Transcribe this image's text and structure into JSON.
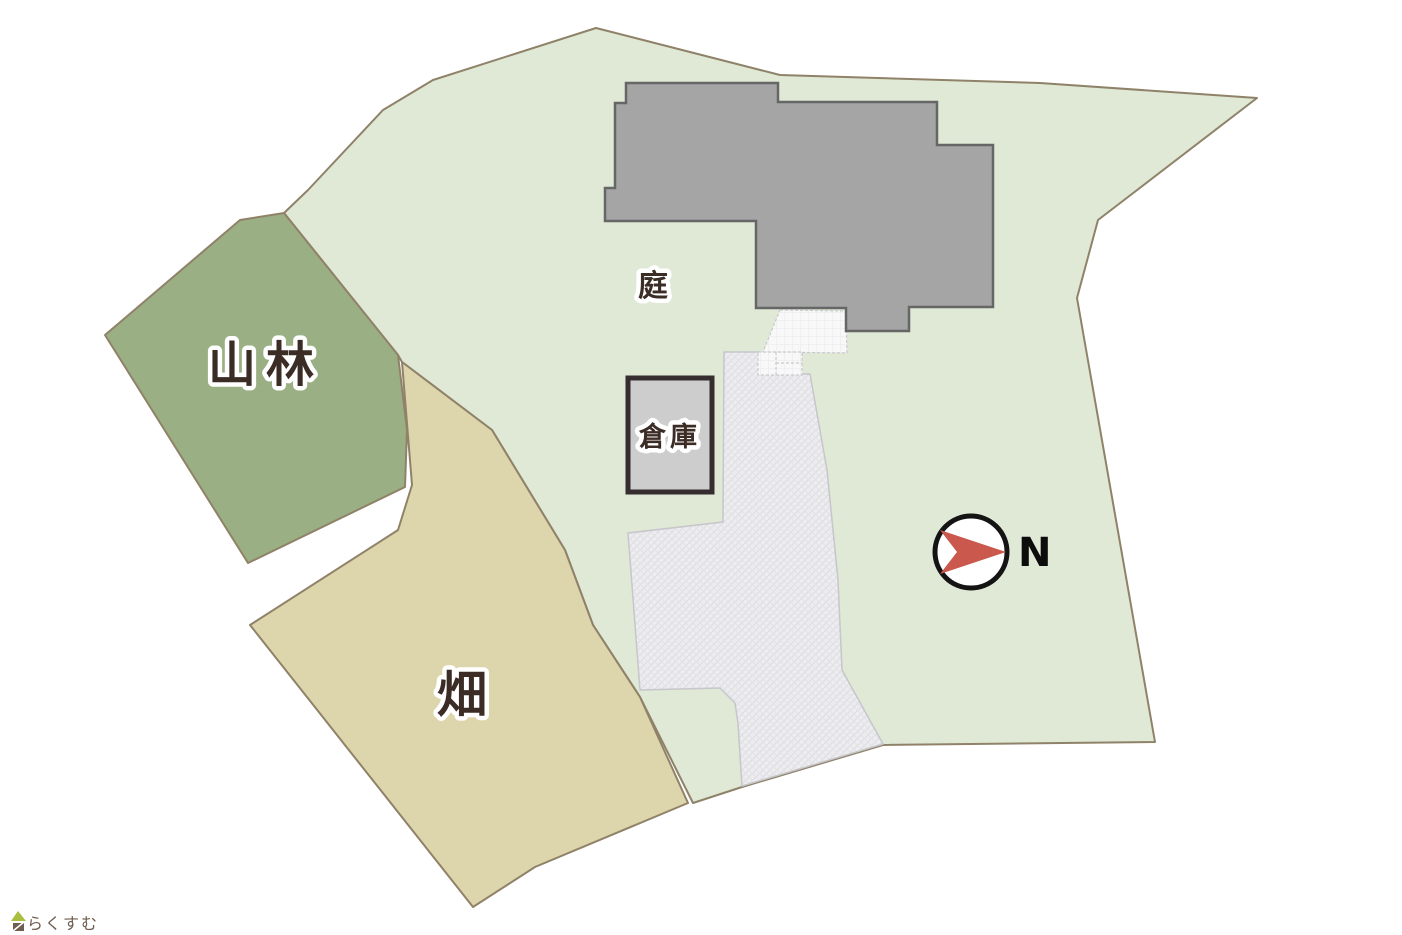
{
  "labels": {
    "forest": "山林",
    "field": "畑",
    "garden": "庭",
    "warehouse": "倉庫",
    "compass_n": "N",
    "logo_text": "らくすむ"
  },
  "colors": {
    "grounds_green": "#dfe9d6",
    "forest_green": "#9aaf83",
    "field_beige": "#ddd5ab",
    "parcel_border": "#8f8269",
    "house_fill": "#a5a5a5",
    "house_border": "#666666",
    "warehouse_fill": "#cdcdcd",
    "warehouse_border": "#352d2f",
    "driveway_fill": "#ededef",
    "porch_fill": "#f8f8f8",
    "compass_red": "#ca584c",
    "label_ink": "#3b2d26",
    "logo_brown": "#6e5d50",
    "logo_roof_green": "#aabf3f"
  },
  "geometry": {
    "main_grounds": "596,28 780,75 1040,83 1257,98 1098,220 1077,298 1155,742 883,745 742,787 693,803 640,697 593,625 565,550 492,430 402,362 398,355 284,213 308,190 383,110 433,80",
    "forest": "240,220 284,213 398,355 407,430 405,487 248,563 105,335",
    "field": "402,362 492,430 565,550 593,625 640,697 688,803 535,867 473,907 250,625 398,530 412,485",
    "driveway": "724,352 760,352 760,374 810,374 827,470 838,580 842,670 883,744 742,786 738,723 735,703 720,688 640,690 628,533 723,522",
    "house": "626,83 778,83 778,102 937,102 937,145 993,145 993,307 909,307 909,331 846,331 846,308 756,308 756,221 605,221 605,188 615,188 615,103 626,103",
    "porch": "780,310 846,311 847,353 763,352",
    "porch_box": {
      "x": "758",
      "y": "352",
      "width": "44",
      "height": "23"
    },
    "warehouse_rect": {
      "x": "628",
      "y": "378",
      "width": "84",
      "height": "114"
    },
    "compass": {
      "cx": "971",
      "cy": "552",
      "r": "36"
    },
    "north_arrow": "940,530 1006,552 940,574 957,552",
    "logo_roof": "11,921 18,911 26,921",
    "logo_body": "13,923 24,923 24,931 13,931"
  },
  "label_positions": {
    "forest": {
      "x": "266",
      "y": "381"
    },
    "field": {
      "x": "462",
      "y": "712"
    },
    "garden": {
      "x": "653",
      "y": "296"
    },
    "warehouse": {
      "x": "670",
      "y": "446"
    },
    "compass_n": {
      "x": "1018",
      "y": "566"
    },
    "logo_text": {
      "x": "27",
      "y": "929"
    }
  }
}
